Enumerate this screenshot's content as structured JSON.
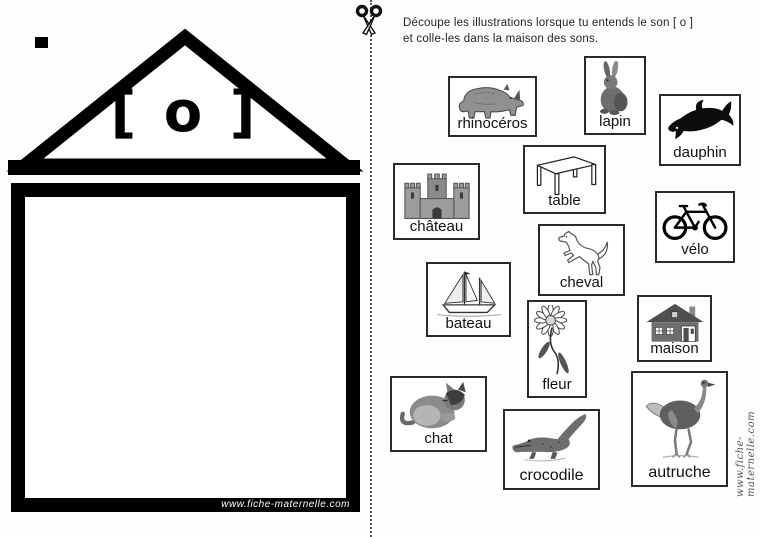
{
  "instructions": {
    "line1": "Découpe les illustrations lorsque tu entends le son [ o ]",
    "line2": "et colle-les dans la maison des sons."
  },
  "house": {
    "phoneme": "[ o ]",
    "watermark": "www.fiche-maternelle.com"
  },
  "side_watermark": "www.fiche-maternelle.com",
  "icons": {
    "scissors": "open scissors on vertical dotted cut line"
  },
  "colors": {
    "ink": "#000000",
    "card_border": "#2a2a2a",
    "illustration_gray": "#6e6e6e",
    "watermark_gray": "#555555"
  },
  "cards": [
    {
      "id": "rhinoceros",
      "label": "rhinocéros"
    },
    {
      "id": "lapin",
      "label": "lapin"
    },
    {
      "id": "dauphin",
      "label": "dauphin"
    },
    {
      "id": "chateau",
      "label": "château"
    },
    {
      "id": "table",
      "label": "table"
    },
    {
      "id": "velo",
      "label": "vélo"
    },
    {
      "id": "cheval",
      "label": "cheval"
    },
    {
      "id": "bateau",
      "label": "bateau"
    },
    {
      "id": "fleur",
      "label": "fleur"
    },
    {
      "id": "maison",
      "label": "maison"
    },
    {
      "id": "chat",
      "label": "chat"
    },
    {
      "id": "crocodile",
      "label": "crocodile"
    },
    {
      "id": "autruche",
      "label": "autruche"
    }
  ]
}
